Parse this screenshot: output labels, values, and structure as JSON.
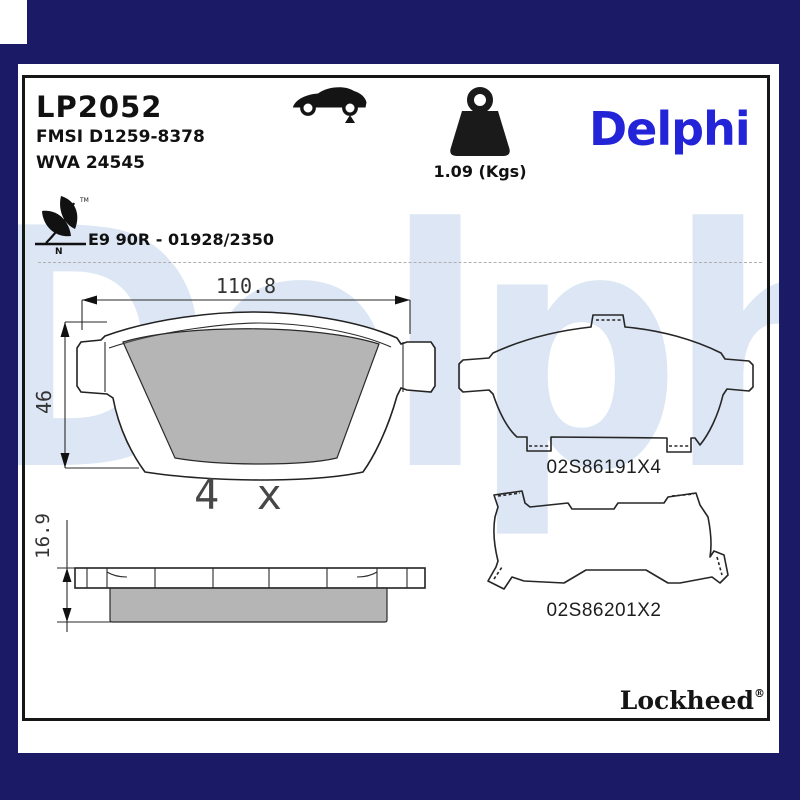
{
  "header": {
    "part_number": "LP2052",
    "fmsi_line": "FMSI D1259-8378",
    "wva_line": "WVA 24545",
    "weight_label": "1.09 (Kgs)",
    "brand_logo": "Delphi",
    "homologation": "E9 90R - 01928/2350",
    "eco_mark_tm": "TM",
    "eco_mark_n": "N"
  },
  "watermark_text": "Delphi",
  "drawing": {
    "dim_width": "110.8",
    "dim_height": "46",
    "dim_thickness": "16.9",
    "quantity_label": "4 x"
  },
  "accessories": [
    {
      "code": "02S86191X4"
    },
    {
      "code": "02S86201X2"
    }
  ],
  "footer": {
    "brand": "Lockheed",
    "registered": "®"
  },
  "icons": [
    {
      "name": "car-icon",
      "meaning": "vehicle application, rear axle marker"
    },
    {
      "name": "weight-icon",
      "meaning": "package weight"
    },
    {
      "name": "eco-leaf-icon",
      "meaning": "low-emission friction material"
    }
  ],
  "colors": {
    "frame_navy": "#1a1a66",
    "logo_blue": "#2323d8",
    "watermark_blue": "#dce6f4",
    "friction_gray": "#b9b9b9",
    "line_black": "#222222"
  }
}
